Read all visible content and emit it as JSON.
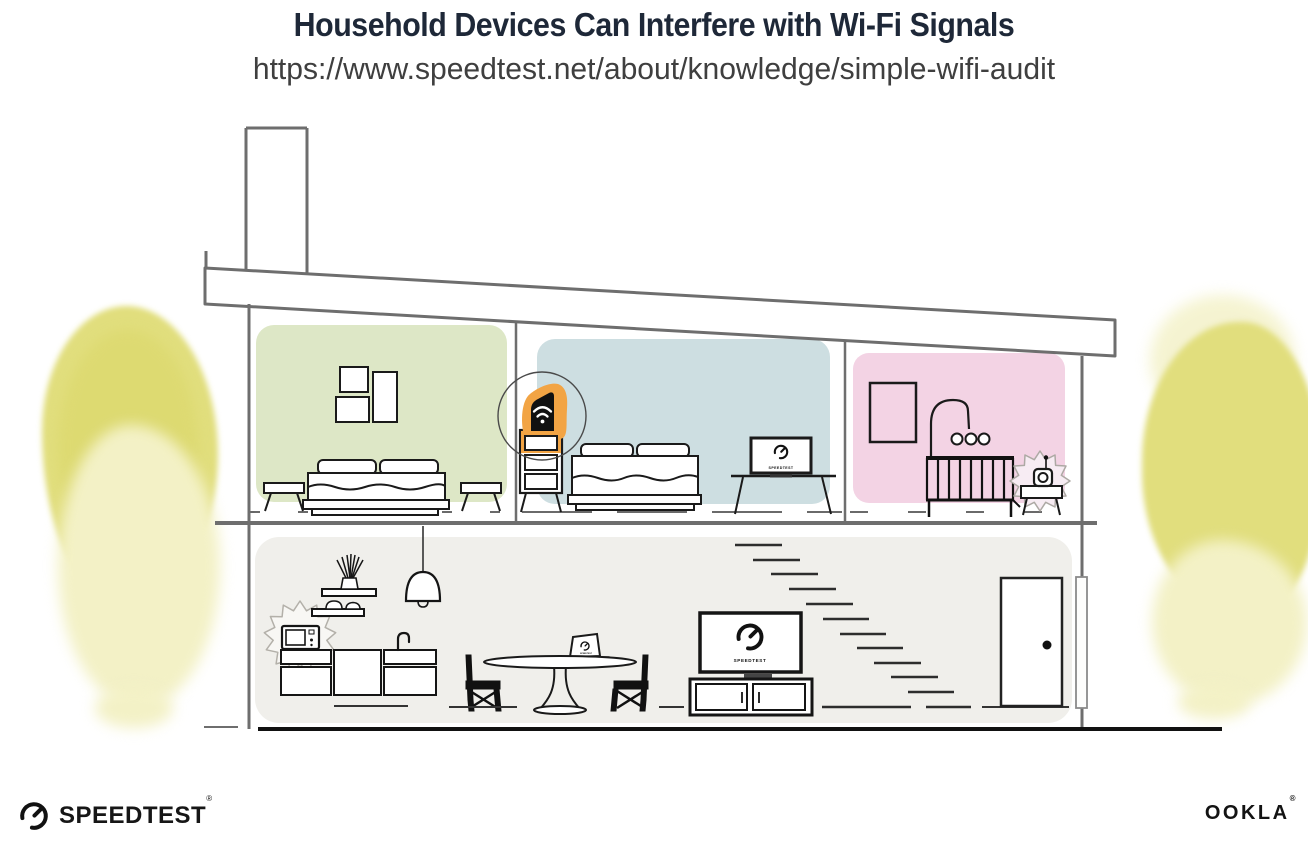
{
  "header": {
    "title": "Household Devices Can Interfere with Wi-Fi Signals",
    "url": "https://www.speedtest.net/about/knowledge/simple-wifi-audit"
  },
  "illustration": {
    "scene": "cross-section of a two-story house",
    "rooms": [
      {
        "id": "bedroom-left",
        "wall_color": "#DDE7C6",
        "items": [
          "picture-frames",
          "double-bed",
          "side-stools"
        ]
      },
      {
        "id": "bedroom-middle",
        "wall_color": "#CDDEE1",
        "items": [
          "dresser",
          "wifi-router",
          "double-bed",
          "desk-with-monitor"
        ]
      },
      {
        "id": "nursery",
        "wall_color": "#F3D3E4",
        "items": [
          "picture-frame",
          "crib-with-mobile",
          "baby-monitor-on-table"
        ]
      },
      {
        "id": "main-floor",
        "wall_color": "#F0EFEB",
        "items": [
          "microwave",
          "kitchen-cabinets",
          "wall-shelves",
          "pendant-lamp",
          "dining-table",
          "laptop",
          "chairs",
          "tv",
          "media-console",
          "stairs",
          "door",
          "downspout"
        ]
      }
    ],
    "highlighted_device": {
      "name": "wifi-router",
      "highlight_color": "#F2A444"
    },
    "interference_sources": [
      "microwave",
      "baby-monitor"
    ]
  },
  "screens": {
    "tv": "SPEEDTEST",
    "monitor": "SPEEDTEST",
    "laptop": "SPEEDTEST"
  },
  "footer": {
    "speedtest_wordmark": "SPEEDTEST",
    "speedtest_reg": "®",
    "ookla_wordmark": "OOKLA",
    "ookla_reg": "®"
  },
  "colors": {
    "title_text": "#1E2838",
    "url_text": "#3F3F3F",
    "structure_line": "#6E6E6E",
    "furniture_line": "#1A1A1A",
    "room_green": "#DDE7C6",
    "room_blue": "#CDDEE1",
    "room_pink": "#F3D3E4",
    "floor_gray": "#F0EFEB",
    "highlight_orange": "#F2A444",
    "foliage_yellow": "#E1DE7D",
    "foliage_light": "#F3F1C6"
  }
}
